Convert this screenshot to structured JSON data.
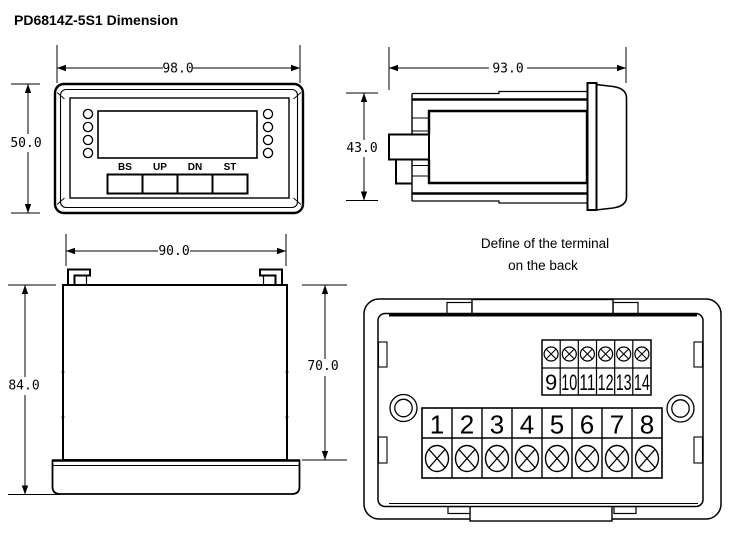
{
  "title": "PD6814Z-5S1 Dimension",
  "front_view": {
    "width_label": "98.0",
    "height_label": "50.0",
    "buttons": [
      "BS",
      "UP",
      "DN",
      "ST"
    ]
  },
  "side_view": {
    "width_label": "93.0",
    "height_label": "43.0"
  },
  "bottom_view": {
    "width_label": "90.0",
    "total_height_label": "84.0",
    "body_height_label": "70.0"
  },
  "back_view": {
    "caption_line1": "Define of the terminal",
    "caption_line2": "on the back",
    "top_terminals": [
      "9",
      "10",
      "11",
      "12",
      "13",
      "14"
    ],
    "bottom_terminals": [
      "1",
      "2",
      "3",
      "4",
      "5",
      "6",
      "7",
      "8"
    ]
  },
  "colors": {
    "line": "#000000",
    "background": "#ffffff"
  }
}
